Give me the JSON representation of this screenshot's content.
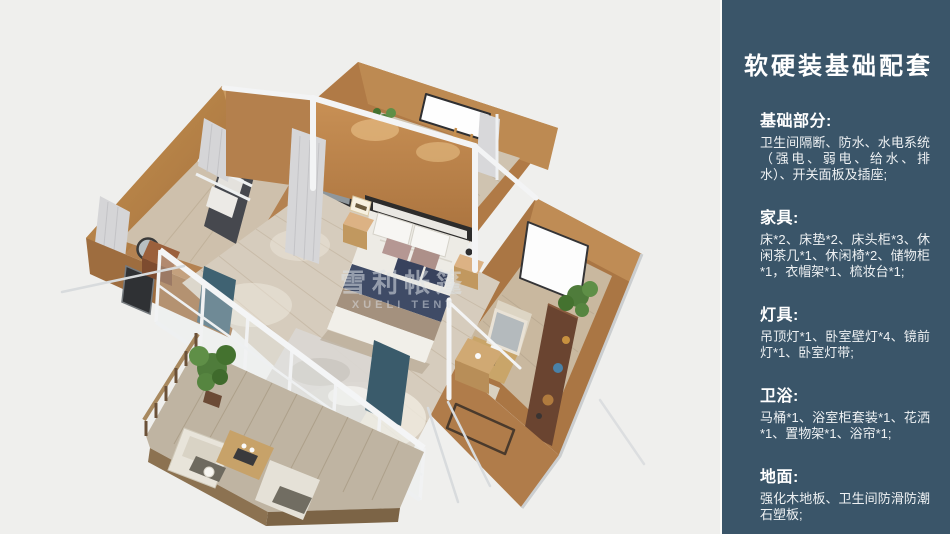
{
  "sidebar": {
    "title": "软硬装基础配套",
    "bg_color": "#3a5569",
    "text_color": "#ffffff",
    "sections": [
      {
        "heading": "基础部分:",
        "body": "卫生间隔断、防水、水电系统（强电、弱电、给水、排水）、开关面板及插座;"
      },
      {
        "heading": "家具:",
        "body": "床*2、床垫*2、床头柜*3、休闲茶几*1、休闲椅*2、储物柜*1，衣帽架*1、梳妆台*1;"
      },
      {
        "heading": "灯具:",
        "body": "吊顶灯*1、卧室壁灯*4、镜前灯*1、卧室灯带;"
      },
      {
        "heading": "卫浴:",
        "body": "马桶*1、浴室柜套装*1、花洒*1、置物架*1、浴帘*1;"
      },
      {
        "heading": "地面:",
        "body": "强化木地板、卫生间防滑防潮石塑板;"
      }
    ]
  },
  "scene": {
    "watermark_cn": "雪利帐篷",
    "watermark_en": "XUELI TENT",
    "background_color": "#efefed",
    "wall_tan": "#b9824e",
    "wall_dark": "#9e6d3f",
    "floor_wood": "#d6ccbd",
    "deck_wood": "#bfb4a2",
    "frame_white": "#f3f4f5",
    "bed_runner_navy": "#3f4b66",
    "curtain_gray": "#d6d6d8",
    "curtain_teal": "#3f6272",
    "plant_green": "#4f7c3b",
    "sofa_gray": "#46484e",
    "shelf_walnut": "#6a4430"
  }
}
